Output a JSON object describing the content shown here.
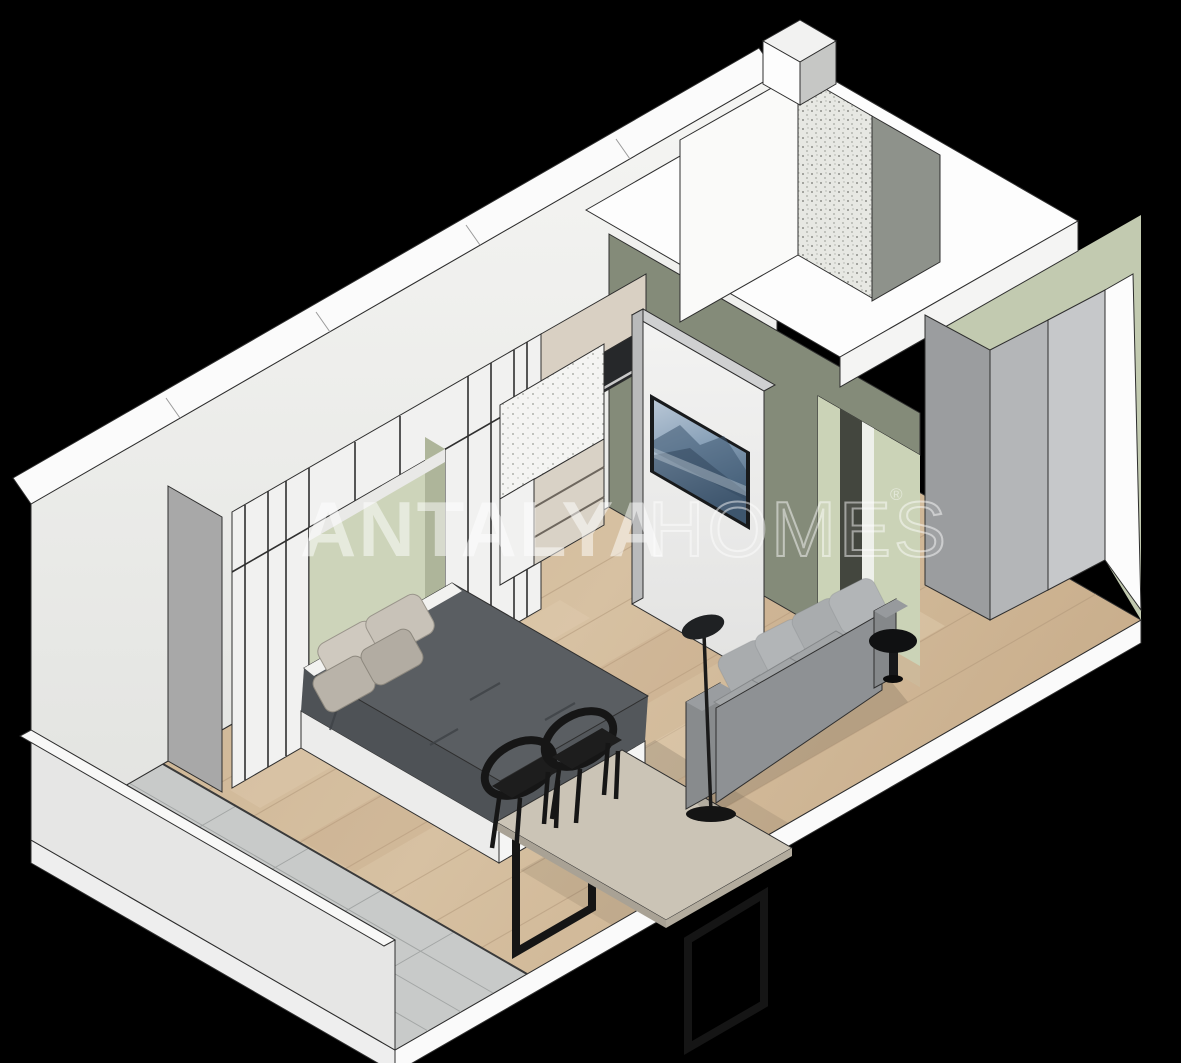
{
  "scene": {
    "type": "isometric-apartment-cutaway-render",
    "background_color": "#000000",
    "rooms": [
      "balcony",
      "sleeping-area",
      "kitchenette",
      "living-area",
      "entrance-hall",
      "bathroom"
    ],
    "furniture": [
      "double-bed",
      "wardrobe-wall",
      "tv-partition",
      "dining-table",
      "dining-chair",
      "dining-chair",
      "sofa",
      "floor-lamp",
      "side-table",
      "entrance-cabinet"
    ]
  },
  "watermark": {
    "brand_primary": "ANTALYA",
    "brand_secondary": "HOMES",
    "registered_mark": "®",
    "color": "#ffffff"
  },
  "palette": {
    "background": "#000000",
    "wall_white": "#f2f2f1",
    "wall_side_gray": "#a8a8a8",
    "accent_sage": "#cdd4ba",
    "accent_olive": "#848b79",
    "floor_wood": "#cfb697",
    "floor_tile": "#c8cac9",
    "duvet_gray": "#5a5e62",
    "sofa_gray": "#8e9194",
    "frame_black": "#161616",
    "tv_screen_blue": "#7f97ae",
    "kitchen_cream": "#d9d0c3"
  }
}
